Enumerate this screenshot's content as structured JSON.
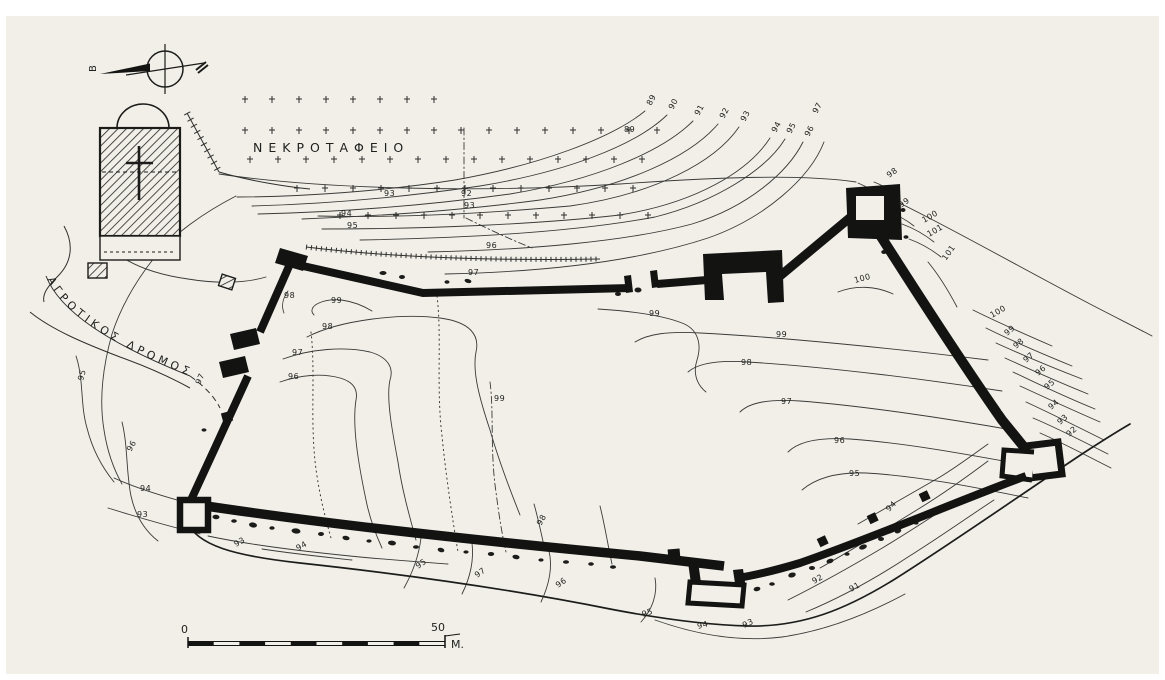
{
  "map": {
    "colors": {
      "ink": "#161614",
      "paper": "#f1efe8"
    },
    "north_indicator": {
      "label": "Β"
    },
    "cemetery": {
      "label": "ΝΕΚΡΟΤΑΦΕΙΟ",
      "crosses": [
        [
          245,
          100
        ],
        [
          272,
          100
        ],
        [
          299,
          100
        ],
        [
          326,
          100
        ],
        [
          353,
          100
        ],
        [
          380,
          100
        ],
        [
          407,
          100
        ],
        [
          434,
          100
        ],
        [
          245,
          131
        ],
        [
          272,
          131
        ],
        [
          299,
          131
        ],
        [
          326,
          131
        ],
        [
          353,
          131
        ],
        [
          380,
          131
        ],
        [
          407,
          131
        ],
        [
          434,
          131
        ],
        [
          461,
          131
        ],
        [
          489,
          131
        ],
        [
          517,
          131
        ],
        [
          545,
          131
        ],
        [
          573,
          131
        ],
        [
          601,
          131
        ],
        [
          629,
          131
        ],
        [
          657,
          131
        ],
        [
          250,
          160
        ],
        [
          278,
          160
        ],
        [
          306,
          160
        ],
        [
          334,
          160
        ],
        [
          362,
          160
        ],
        [
          390,
          160
        ],
        [
          418,
          160
        ],
        [
          446,
          160
        ],
        [
          474,
          160
        ],
        [
          502,
          160
        ],
        [
          530,
          160
        ],
        [
          558,
          160
        ],
        [
          586,
          160
        ],
        [
          614,
          160
        ],
        [
          642,
          160
        ],
        [
          297,
          189
        ],
        [
          325,
          189
        ],
        [
          353,
          189
        ],
        [
          381,
          189
        ],
        [
          409,
          189
        ],
        [
          437,
          189
        ],
        [
          465,
          189
        ],
        [
          493,
          189
        ],
        [
          521,
          189
        ],
        [
          549,
          189
        ],
        [
          577,
          189
        ],
        [
          605,
          189
        ],
        [
          633,
          189
        ],
        [
          340,
          216
        ],
        [
          368,
          216
        ],
        [
          396,
          216
        ],
        [
          424,
          216
        ],
        [
          452,
          216
        ],
        [
          480,
          216
        ],
        [
          508,
          216
        ],
        [
          536,
          216
        ],
        [
          564,
          216
        ],
        [
          592,
          216
        ],
        [
          620,
          216
        ],
        [
          648,
          216
        ]
      ]
    },
    "road": {
      "label": "ΑΓΡΟΤΙΚΟΣ ΔΡΟΜΟΣ"
    },
    "scale_bar": {
      "start": "0",
      "end": "50",
      "unit": "M."
    },
    "contour_labels": [
      {
        "v": "89",
        "x": 651,
        "y": 106,
        "r": -62
      },
      {
        "v": "90",
        "x": 673,
        "y": 110,
        "r": -62
      },
      {
        "v": "91",
        "x": 699,
        "y": 116,
        "r": -62
      },
      {
        "v": "92",
        "x": 724,
        "y": 119,
        "r": -62
      },
      {
        "v": "93",
        "x": 745,
        "y": 122,
        "r": -62
      },
      {
        "v": "94",
        "x": 776,
        "y": 133,
        "r": -62
      },
      {
        "v": "95",
        "x": 791,
        "y": 134,
        "r": -62
      },
      {
        "v": "96",
        "x": 809,
        "y": 137,
        "r": -62
      },
      {
        "v": "97",
        "x": 817,
        "y": 114,
        "r": -62
      },
      {
        "v": "89",
        "x": 624,
        "y": 132,
        "r": 0
      },
      {
        "v": "93",
        "x": 384,
        "y": 196,
        "r": 0
      },
      {
        "v": "92",
        "x": 461,
        "y": 196,
        "r": 0
      },
      {
        "v": "93",
        "x": 464,
        "y": 208,
        "r": 0
      },
      {
        "v": "94",
        "x": 341,
        "y": 216,
        "r": 0
      },
      {
        "v": "95",
        "x": 347,
        "y": 228,
        "r": 0
      },
      {
        "v": "96",
        "x": 486,
        "y": 248,
        "r": 0
      },
      {
        "v": "97",
        "x": 468,
        "y": 275,
        "r": 0
      },
      {
        "v": "98",
        "x": 889,
        "y": 178,
        "r": -35
      },
      {
        "v": "99",
        "x": 901,
        "y": 208,
        "r": -35
      },
      {
        "v": "100",
        "x": 924,
        "y": 223,
        "r": -30
      },
      {
        "v": "101",
        "x": 929,
        "y": 237,
        "r": -30
      },
      {
        "v": "101",
        "x": 946,
        "y": 261,
        "r": -55
      },
      {
        "v": "100",
        "x": 855,
        "y": 283,
        "r": -15
      },
      {
        "v": "100",
        "x": 992,
        "y": 318,
        "r": -30
      },
      {
        "v": "99",
        "x": 1007,
        "y": 336,
        "r": -40
      },
      {
        "v": "98",
        "x": 1016,
        "y": 349,
        "r": -40
      },
      {
        "v": "97",
        "x": 1026,
        "y": 363,
        "r": -40
      },
      {
        "v": "96",
        "x": 1038,
        "y": 376,
        "r": -40
      },
      {
        "v": "95",
        "x": 1047,
        "y": 390,
        "r": -40
      },
      {
        "v": "94",
        "x": 1051,
        "y": 410,
        "r": -40
      },
      {
        "v": "93",
        "x": 1060,
        "y": 425,
        "r": -40
      },
      {
        "v": "92",
        "x": 1069,
        "y": 437,
        "r": -40
      },
      {
        "v": "99",
        "x": 776,
        "y": 337,
        "r": 0
      },
      {
        "v": "98",
        "x": 741,
        "y": 365,
        "r": 0
      },
      {
        "v": "97",
        "x": 781,
        "y": 404,
        "r": 0
      },
      {
        "v": "96",
        "x": 834,
        "y": 443,
        "r": 0
      },
      {
        "v": "95",
        "x": 849,
        "y": 476,
        "r": 0
      },
      {
        "v": "98",
        "x": 284,
        "y": 298,
        "r": 0
      },
      {
        "v": "99",
        "x": 331,
        "y": 303,
        "r": 0
      },
      {
        "v": "98",
        "x": 322,
        "y": 329,
        "r": 0
      },
      {
        "v": "97",
        "x": 292,
        "y": 355,
        "r": 0
      },
      {
        "v": "96",
        "x": 288,
        "y": 379,
        "r": 0
      },
      {
        "v": "99",
        "x": 494,
        "y": 401,
        "r": 0
      },
      {
        "v": "99",
        "x": 649,
        "y": 316,
        "r": 0
      },
      {
        "v": "97",
        "x": 200,
        "y": 385,
        "r": -65
      },
      {
        "v": "95",
        "x": 83,
        "y": 381,
        "r": -75
      },
      {
        "v": "96",
        "x": 131,
        "y": 452,
        "r": -60
      },
      {
        "v": "94",
        "x": 140,
        "y": 491,
        "r": 0
      },
      {
        "v": "93",
        "x": 137,
        "y": 517,
        "r": 0
      },
      {
        "v": "93",
        "x": 236,
        "y": 547,
        "r": -30
      },
      {
        "v": "94",
        "x": 298,
        "y": 551,
        "r": -30
      },
      {
        "v": "95",
        "x": 418,
        "y": 569,
        "r": -35
      },
      {
        "v": "97",
        "x": 477,
        "y": 578,
        "r": -35
      },
      {
        "v": "96",
        "x": 558,
        "y": 588,
        "r": -35
      },
      {
        "v": "98",
        "x": 541,
        "y": 526,
        "r": -60
      },
      {
        "v": "95",
        "x": 643,
        "y": 617,
        "r": -20
      },
      {
        "v": "94",
        "x": 698,
        "y": 629,
        "r": -15
      },
      {
        "v": "93",
        "x": 744,
        "y": 628,
        "r": -25
      },
      {
        "v": "92",
        "x": 814,
        "y": 584,
        "r": -30
      },
      {
        "v": "91",
        "x": 851,
        "y": 592,
        "r": -30
      },
      {
        "v": "94",
        "x": 889,
        "y": 512,
        "r": -45
      }
    ],
    "rubble": [
      [
        357,
        277,
        4,
        2.5,
        10
      ],
      [
        383,
        273,
        3.5,
        2,
        0
      ],
      [
        402,
        277,
        3,
        2,
        0
      ],
      [
        447,
        282,
        2.5,
        1.8,
        0
      ],
      [
        468,
        281,
        3.5,
        2,
        15
      ],
      [
        618,
        294,
        3,
        2,
        0
      ],
      [
        638,
        290,
        3.5,
        2.5,
        0
      ],
      [
        893,
        197,
        3,
        2.2,
        20
      ],
      [
        903,
        210,
        2.5,
        2,
        0
      ],
      [
        897,
        224,
        3,
        2,
        40
      ],
      [
        906,
        237,
        2.5,
        1.8,
        0
      ],
      [
        884,
        252,
        2.8,
        2,
        0
      ],
      [
        216,
        517,
        3.5,
        2.2,
        5
      ],
      [
        234,
        521,
        2.8,
        1.8,
        0
      ],
      [
        253,
        525,
        4,
        2.5,
        10
      ],
      [
        272,
        528,
        2.6,
        1.8,
        0
      ],
      [
        296,
        531,
        4.5,
        2.6,
        8
      ],
      [
        321,
        534,
        3,
        2,
        0
      ],
      [
        346,
        538,
        3.6,
        2.2,
        12
      ],
      [
        369,
        541,
        2.6,
        1.6,
        0
      ],
      [
        392,
        543,
        4,
        2.4,
        6
      ],
      [
        416,
        547,
        3,
        1.8,
        0
      ],
      [
        441,
        550,
        3.4,
        2.2,
        14
      ],
      [
        466,
        552,
        2.6,
        1.6,
        0
      ],
      [
        491,
        554,
        3.2,
        2,
        0
      ],
      [
        516,
        557,
        3.6,
        2.2,
        10
      ],
      [
        541,
        560,
        2.6,
        1.6,
        0
      ],
      [
        566,
        562,
        3,
        1.8,
        0
      ],
      [
        591,
        564,
        2.8,
        1.8,
        0
      ],
      [
        613,
        567,
        3,
        1.8,
        0
      ],
      [
        702,
        591,
        4.5,
        3,
        0
      ],
      [
        717,
        596,
        3.6,
        2.4,
        0
      ],
      [
        731,
        599,
        3,
        2,
        0
      ],
      [
        757,
        589,
        3.4,
        2.2,
        -10
      ],
      [
        772,
        584,
        2.8,
        1.8,
        0
      ],
      [
        792,
        575,
        3.8,
        2.4,
        -15
      ],
      [
        812,
        568,
        3,
        2,
        0
      ],
      [
        830,
        561,
        3.6,
        2.2,
        -18
      ],
      [
        847,
        554,
        2.6,
        1.8,
        0
      ],
      [
        863,
        547,
        4,
        2.4,
        -20
      ],
      [
        881,
        539,
        3,
        2,
        0
      ],
      [
        898,
        531,
        3.4,
        2.2,
        -20
      ],
      [
        916,
        523,
        2.6,
        1.6,
        0
      ],
      [
        931,
        515,
        3,
        1.8,
        -25
      ],
      [
        946,
        506,
        2.6,
        1.6,
        0
      ],
      [
        204,
        430,
        2.5,
        1.6,
        0
      ]
    ]
  }
}
